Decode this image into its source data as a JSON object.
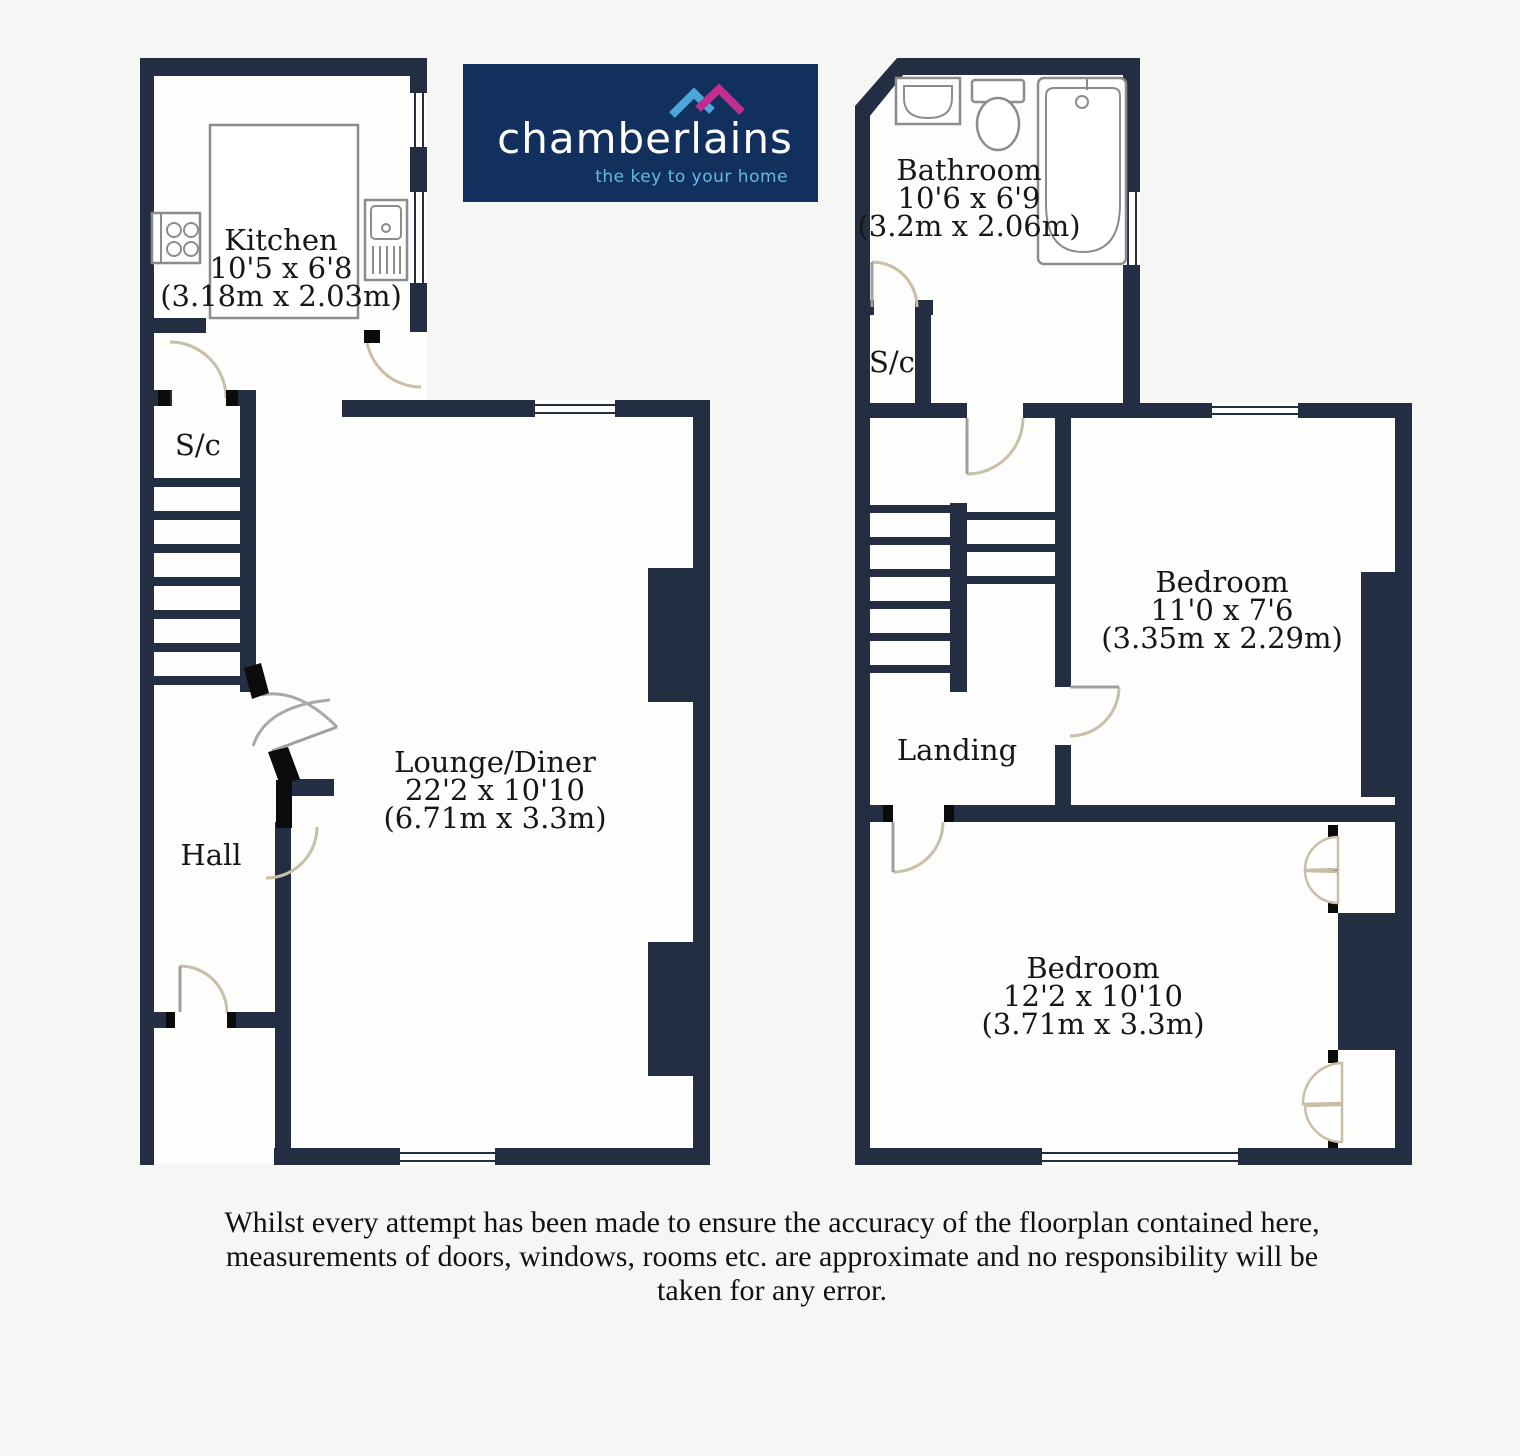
{
  "logo": {
    "brand": "chamberlains",
    "tagline": "the key to your home"
  },
  "colors": {
    "wall": "#232e42",
    "background": "#f6f7f4",
    "room": "#fdfdfc",
    "door_arc": "#c9bfa6",
    "fixture": "#8c8c8c",
    "label": "#161616",
    "logo_bg": "#12305e",
    "logo_text": "#ffffff",
    "tagline": "#66b9e3",
    "roof_left": "#49a8d8",
    "roof_right": "#c22d8e"
  },
  "floors": {
    "ground": {
      "kitchen": {
        "name": "Kitchen",
        "imperial": "10'5 x 6'8",
        "metric": "(3.18m x 2.03m)"
      },
      "sc": {
        "name": "S/c"
      },
      "lounge": {
        "name": "Lounge/Diner",
        "imperial": "22'2 x 10'10",
        "metric": "(6.71m x 3.3m)"
      },
      "hall": {
        "name": "Hall"
      }
    },
    "first": {
      "bathroom": {
        "name": "Bathroom",
        "imperial": "10'6 x 6'9",
        "metric": "(3.2m x 2.06m)"
      },
      "sc": {
        "name": "S/c"
      },
      "bedroom1": {
        "name": "Bedroom",
        "imperial": "11'0 x 7'6",
        "metric": "(3.35m x 2.29m)"
      },
      "landing": {
        "name": "Landing"
      },
      "bedroom2": {
        "name": "Bedroom",
        "imperial": "12'2 x 10'10",
        "metric": "(3.71m x 3.3m)"
      }
    }
  },
  "disclaimer": {
    "line1": "Whilst every attempt has been made to ensure the accuracy of the floorplan contained here,",
    "line2": "measurements of doors, windows, rooms etc. are approximate and no responsibility will be",
    "line3": "taken for any error."
  }
}
